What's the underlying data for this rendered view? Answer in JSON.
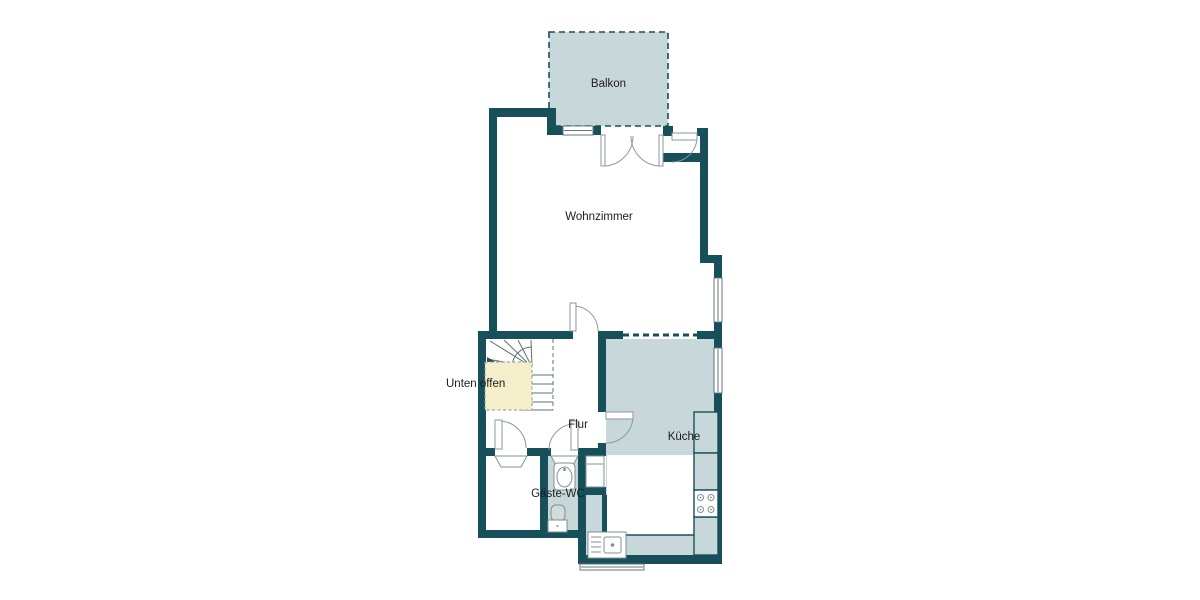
{
  "plan": {
    "rooms": {
      "balkon": {
        "label": "Balkon"
      },
      "wohnzimmer": {
        "label": "Wohnzimmer"
      },
      "unten_offen": {
        "label": "Unten offen"
      },
      "flur": {
        "label": "Flur"
      },
      "kueche": {
        "label": "Küche"
      },
      "gaeste_wc": {
        "label": "Gäste-WC"
      }
    },
    "fixtures": [
      "stairs-icon",
      "stove-icon",
      "kitchen-sink-icon",
      "fridge-icon",
      "wc-sink-icon",
      "toilet-icon"
    ],
    "colors": {
      "wall": "#17505a",
      "room_fill": "#c8d7d9",
      "open_below_fill": "#f4efca",
      "fixture_line": "#7f9094",
      "stair_line": "#5f7074",
      "text": "#1c1c1e",
      "background": "#ffffff"
    }
  }
}
